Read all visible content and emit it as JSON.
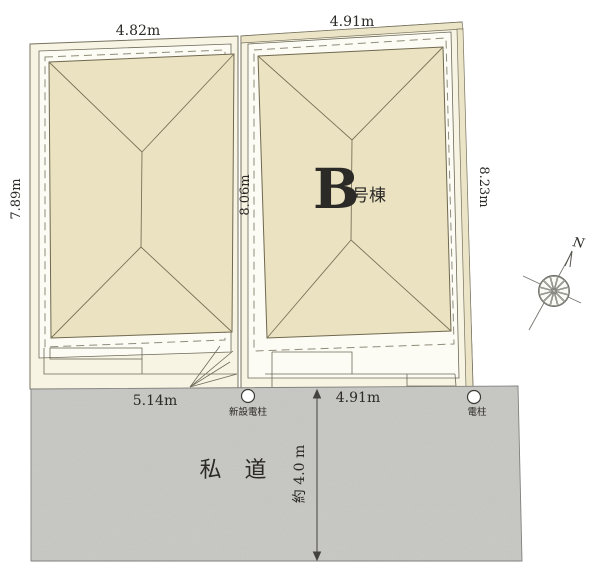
{
  "plan_title": "site-plan",
  "colors": {
    "roof": "#ebe2c1",
    "lot_ground": "#f8f4e3",
    "building_envelope": "#fdfcf4",
    "border_strip": "#ece4c6",
    "road": "#c9c9c6",
    "line": "#55524a",
    "text": "#2b2a26"
  },
  "buildings": {
    "b": {
      "label_letter": "B",
      "label_suffix": "号棟"
    }
  },
  "dimensions": {
    "lot_a_width": "4.82m",
    "lot_b_width": "4.91m",
    "lot_a_depth": "7.89m",
    "center_depth": "8.06m",
    "lot_b_depth": "8.23m",
    "road_frontage_a": "5.14m",
    "road_frontage_b": "4.91m",
    "road_width": "約 4.0 m"
  },
  "road": {
    "label": "私 道"
  },
  "poles": {
    "new_pole_label": "新設電柱",
    "existing_pole_label": "電柱"
  },
  "compass": {
    "north_label": "N"
  }
}
